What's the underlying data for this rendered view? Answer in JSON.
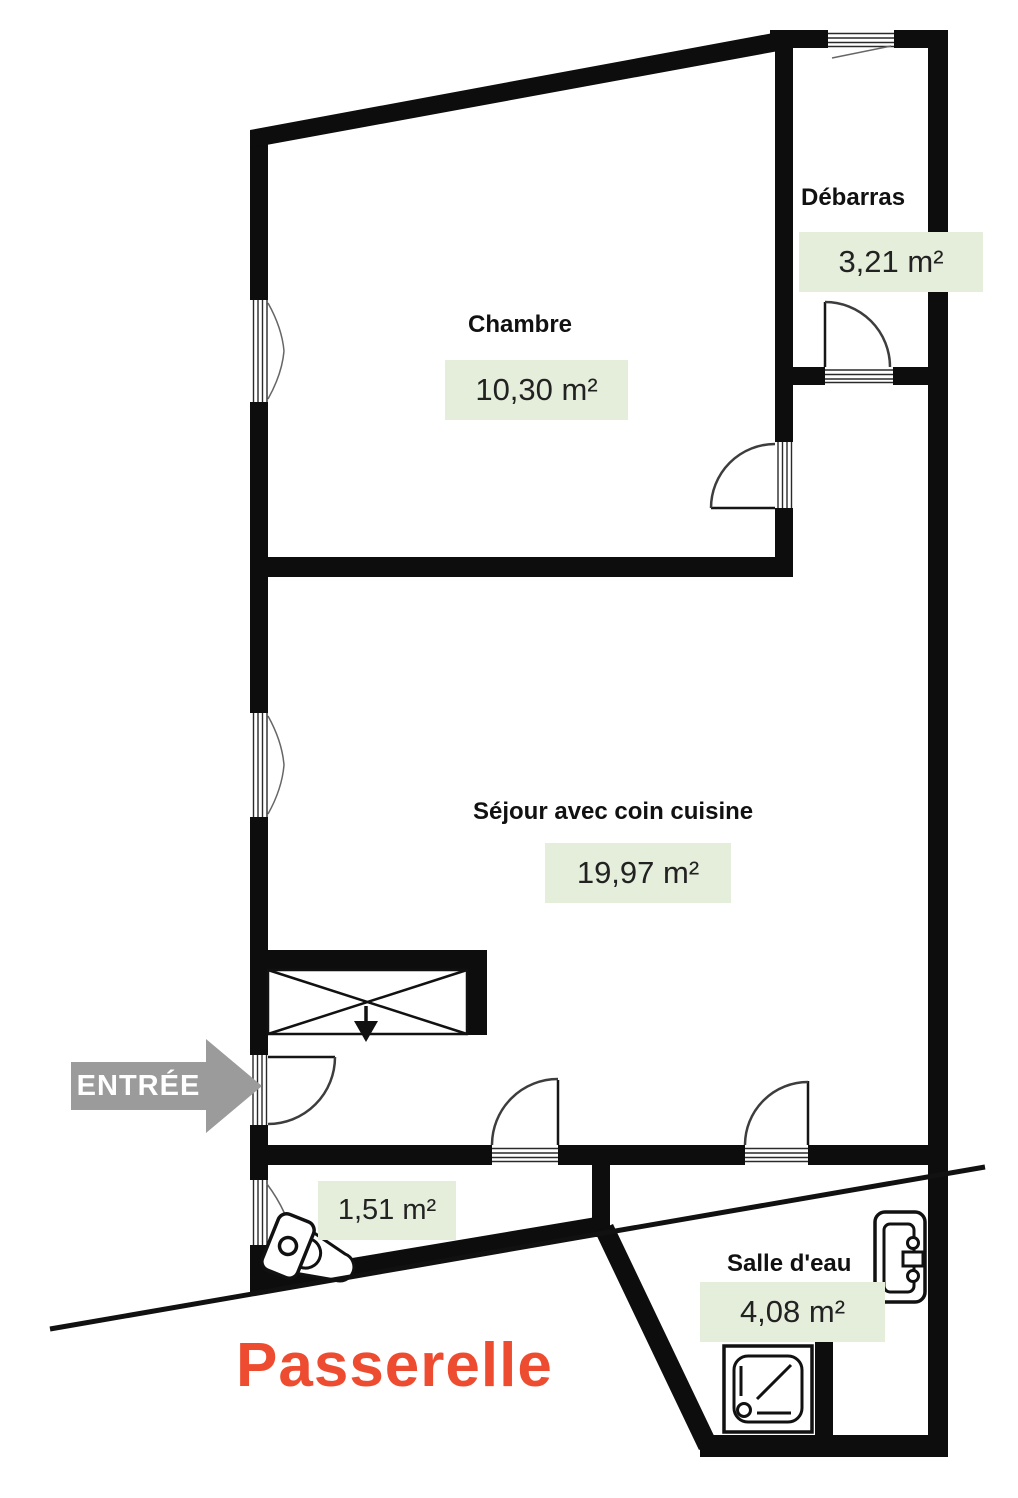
{
  "title": "Plan d'appartement",
  "rooms": {
    "chambre": {
      "label": "Chambre",
      "area": "10,30 m²"
    },
    "debarras": {
      "label": "Débarras",
      "area": "3,21 m²"
    },
    "sejour": {
      "label": "Séjour avec coin cuisine",
      "area": "19,97 m²"
    },
    "wc": {
      "area": "1,51 m²"
    },
    "salle_deau": {
      "label": "Salle d'eau",
      "area": "4,08 m²"
    }
  },
  "entrance": {
    "label": "ENTRÉE"
  },
  "exterior": {
    "label": "Passerelle"
  },
  "icons": [
    "toilet-icon",
    "shower-tray-icon",
    "water-heater-icon",
    "entry-arrow-icon",
    "door-swing-icon",
    "window-icon",
    "kitchen-duct-icon"
  ],
  "colors": {
    "wall": "#0d0d0d",
    "badge_bg": "#e5eedb",
    "badge_text": "#222222",
    "label_text": "#111111",
    "passerelle": "#ee4c30",
    "arrow": "#9b9b9b",
    "linework": "#3d3d3d"
  }
}
